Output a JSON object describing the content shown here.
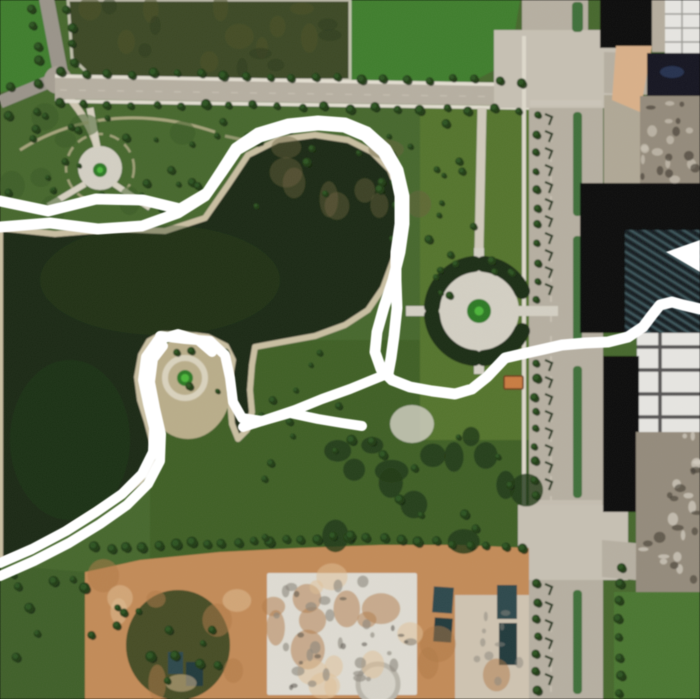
{
  "map": {
    "kind": "satellite-imagery-with-route-overlay",
    "canvas": {
      "width": 700,
      "height": 699
    },
    "colors": {
      "water": "#1b2a12",
      "waterLight": "#2b4220",
      "parkGreen": "#47682e",
      "lawnBright": "#3f7e2e",
      "lawnBright2": "#3a7a2c",
      "fieldDark": "#3c4a26",
      "fieldSouth": "#3f6127",
      "treeDark": "#223c19",
      "treeLight": "#2f5523",
      "road": "#b6afa1",
      "roadLight": "#c6c0b3",
      "median": "#3f6f3a",
      "sidewalk": "#e2ddd0",
      "shorePath": "#c9bfa2",
      "knobSand": "#b9ad8a",
      "plaza": "#d3cfc3",
      "ringDark": "#1e2d18",
      "greenCenter": "#2f7a26",
      "greenCenterBright": "#4db53a",
      "pathTan": "#cdc5b0",
      "dirt": "#c28b58",
      "dirtLight": "#d9b089",
      "slab": "#dedbd2",
      "pads": "#cfc9bb",
      "rubble": "#948b7c",
      "buildingBlack": "#0b0b0d",
      "buildingWhite": "#e6e5e1",
      "glassDark": "#131722",
      "glassNavy": "#25304f",
      "shedTeal": "#2e4a4e",
      "hutOrange": "#c97b43",
      "darkCluster": "#3f4a26",
      "blGreen": "#40602a"
    },
    "overlay": {
      "color": "#ffffff",
      "paths": [
        {
          "name": "route-loop-outer",
          "width": 11,
          "points": [
            [
              0,
              201
            ],
            [
              48,
              211
            ],
            [
              96,
              199
            ],
            [
              143,
              200
            ],
            [
              180,
              209
            ],
            [
              207,
              193
            ],
            [
              222,
              170
            ],
            [
              236,
              148
            ],
            [
              258,
              133
            ],
            [
              288,
              124
            ],
            [
              318,
              121
            ],
            [
              345,
              123
            ],
            [
              367,
              132
            ],
            [
              386,
              149
            ],
            [
              398,
              170
            ],
            [
              404,
              196
            ],
            [
              404,
              224
            ],
            [
              400,
              252
            ],
            [
              393,
              280
            ],
            [
              384,
              307
            ],
            [
              377,
              332
            ],
            [
              375,
              352
            ],
            [
              381,
              369
            ],
            [
              392,
              380
            ],
            [
              410,
              387
            ],
            [
              432,
              391
            ],
            [
              455,
              394
            ],
            [
              472,
              389
            ],
            [
              487,
              377
            ],
            [
              505,
              358
            ],
            [
              522,
              354
            ],
            [
              540,
              350
            ],
            [
              562,
              345
            ],
            [
              585,
              343
            ],
            [
              608,
              342
            ],
            [
              628,
              337
            ],
            [
              643,
              327
            ],
            [
              652,
              315
            ],
            [
              660,
              305
            ],
            [
              672,
              302
            ],
            [
              683,
              305
            ],
            [
              700,
              309
            ]
          ]
        },
        {
          "name": "route-loop-inner",
          "width": 11,
          "points": [
            [
              0,
              227
            ],
            [
              50,
              223
            ],
            [
              98,
              229
            ],
            [
              142,
              226
            ],
            [
              178,
              213
            ],
            [
              205,
              196
            ],
            [
              222,
              172
            ],
            [
              237,
              150
            ],
            [
              260,
              137
            ],
            [
              290,
              128
            ],
            [
              318,
              125
            ],
            [
              344,
              127
            ],
            [
              365,
              136
            ],
            [
              383,
              152
            ],
            [
              395,
              172
            ],
            [
              400,
              196
            ],
            [
              400,
              224
            ],
            [
              396,
              252
            ],
            [
              396,
              280
            ],
            [
              397,
              308
            ],
            [
              394,
              336
            ],
            [
              391,
              358
            ],
            [
              388,
              374
            ]
          ]
        },
        {
          "name": "route-peninsula-east",
          "width": 10,
          "points": [
            [
              160,
              336
            ],
            [
              185,
              339
            ],
            [
              210,
              341
            ],
            [
              225,
              355
            ],
            [
              230,
              378
            ],
            [
              233,
              402
            ],
            [
              242,
              418
            ],
            [
              262,
              421
            ],
            [
              290,
              413
            ],
            [
              318,
              419
            ],
            [
              342,
              423
            ],
            [
              362,
              426
            ]
          ]
        },
        {
          "name": "route-southwest-outer",
          "width": 10,
          "points": [
            [
              0,
              563
            ],
            [
              32,
              549
            ],
            [
              66,
              531
            ],
            [
              96,
              512
            ],
            [
              122,
              494
            ],
            [
              142,
              474
            ],
            [
              153,
              452
            ],
            [
              154,
              428
            ],
            [
              148,
              404
            ],
            [
              143,
              380
            ],
            [
              146,
              357
            ],
            [
              158,
              340
            ],
            [
              178,
              334
            ],
            [
              198,
              340
            ],
            [
              212,
              352
            ]
          ]
        },
        {
          "name": "route-southwest-inner",
          "width": 10,
          "points": [
            [
              0,
              576
            ],
            [
              34,
              561
            ],
            [
              69,
              543
            ],
            [
              100,
              524
            ],
            [
              127,
              505
            ],
            [
              148,
              484
            ],
            [
              160,
              461
            ],
            [
              161,
              434
            ],
            [
              155,
              408
            ],
            [
              150,
              382
            ],
            [
              153,
              359
            ],
            [
              163,
              346
            ]
          ]
        },
        {
          "name": "route-to-junction",
          "width": 10,
          "points": [
            [
              243,
              427
            ],
            [
              268,
              419
            ],
            [
              295,
              410
            ],
            [
              322,
              399
            ],
            [
              350,
              389
            ],
            [
              372,
              380
            ],
            [
              387,
              374
            ]
          ]
        }
      ],
      "arrow_wedge": [
        [
          700,
          240
        ],
        [
          666,
          252
        ],
        [
          700,
          272
        ]
      ]
    }
  }
}
